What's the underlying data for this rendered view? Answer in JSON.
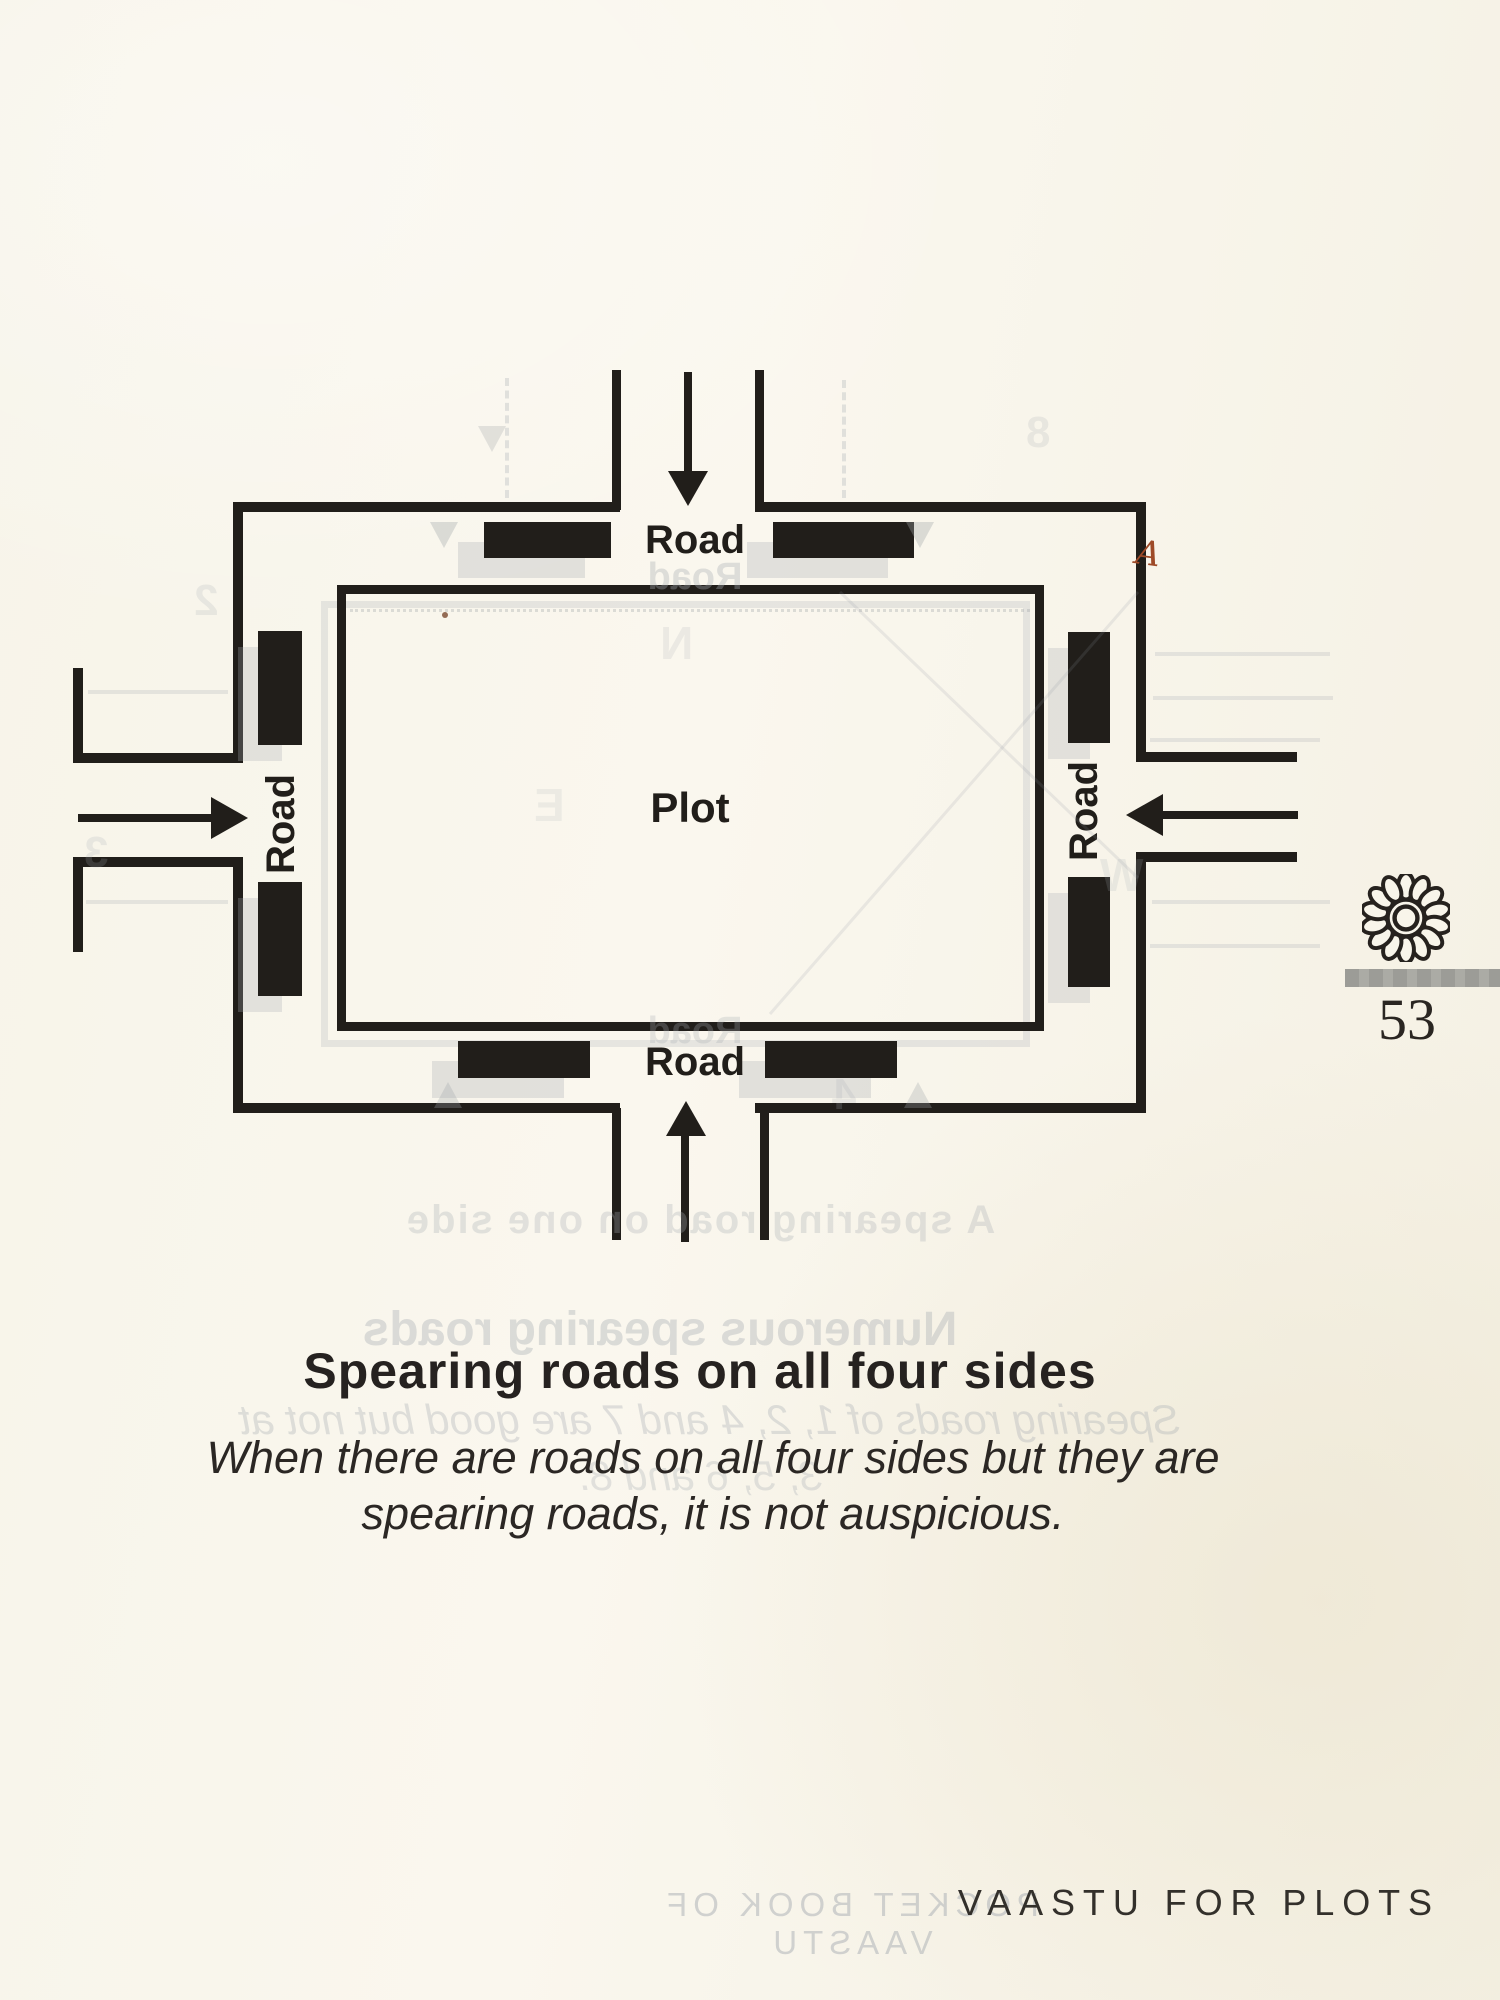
{
  "page": {
    "footer_title": "VAASTU FOR PLOTS",
    "number": "53",
    "paper_color": "#f8f5ea",
    "ink_color": "#211e1a",
    "rule_color": "#a3a3a0",
    "annotation_color": "#9e4a28"
  },
  "diagram": {
    "plot_label": "Plot",
    "road_labels": {
      "top": "Road",
      "left": "Road",
      "right": "Road",
      "bottom": "Road"
    },
    "annotation_mark": "A",
    "ornament": "sunflower-icon"
  },
  "caption": {
    "title": "Spearing roads on all four sides",
    "line1": "When there are roads on all four sides but they are",
    "line2": "spearing roads, it is not auspicious."
  },
  "bleed_through": {
    "figure_caption": "A spearing road on one side",
    "heading": "Numerous spearing roads",
    "body1": "Spearing roads of 1, 2, 4 and 7 are good but not at",
    "body2": "3, 5, 6 and 8.",
    "footer": "POCKET BOOK OF VAASTU",
    "road": "Road",
    "letters": [
      "N",
      "W",
      "E"
    ],
    "numbers": [
      "8",
      "2",
      "3",
      "4"
    ]
  }
}
